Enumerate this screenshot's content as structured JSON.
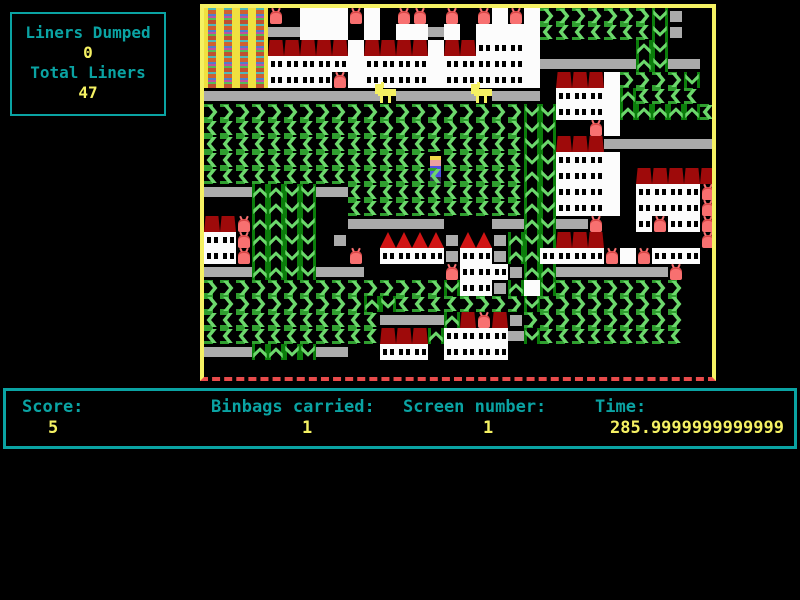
{
  "sidebar": {
    "liners_dumped_label": "Liners Dumped",
    "liners_dumped_value": "0",
    "total_liners_label": "Total Liners",
    "total_liners_value": "47"
  },
  "status_bar": {
    "score_label": "Score:",
    "score_value": "5",
    "binbags_label": "Binbags carried:",
    "binbags_value": "1",
    "screen_label": "Screen number:",
    "screen_value": "1",
    "time_label": "Time:",
    "time_value": "285.9999999999999"
  },
  "colors": {
    "text_teal": "#0aa3a3",
    "text_yellow": "#f5f163",
    "frame_yellow": "#f5f163",
    "frame_bottom_red": "#e84b4b",
    "chevron_light_green": "#6cd86c",
    "chevron_dark_green": "#0b7d0b",
    "conveyor_gray": "#ababab",
    "building_white": "#fcfcfc",
    "roof_dark_red": "#9e0a0a",
    "binbag_red": "#f87070",
    "background": "#000000"
  },
  "game_map": {
    "tile_size": 16,
    "cols": 32,
    "rows": 23,
    "legend": {
      ">": "chevron-right",
      "<": "chevron-left",
      "^": "ladder-up",
      "v": "ladder-down",
      "=": "conveyor",
      "g": "gray-block",
      "#": "building",
      "w": "building-window",
      "R": "roof-flat",
      "h": "roof-pitched",
      "b": "binbag",
      "Y": "rainbow-building",
      "D": "dog",
      "P": "player",
      ".": "empty"
    },
    "tiles": [
      "YYYYb.###b#.bb.b.b#b#>>>>>>>vg..",
      "YYYY==###.#.##=#.####<<<<<<<vg..",
      "YYYYRRRRR#RRRR#RRwww#......^v...",
      "YYYYwwwww#wwww#wwwww#======^v==.",
      "YYYYwwwwb#wwww#wwwww#.RRR#>>>>v.",
      "===========D=====D===.www#^<<<<.",
      ">>>>>>>>>>>>>>>>>>>>vvwww#^^^^^<",
      "<<<<<<<<<<<>>>>>>>>>vv..b#......",
      "<<<<<<<<<<<<<<<<<<<<v^RRR=======",
      "<<<<<<<<<<<<<<P<<<<<vvwww#......",
      "<<<<<<<<<<<<<<<<<<<<^vwww#.RRRRR",
      "===^^vv==<<<<<<<<<<<^vwww#.wwwwb",
      "...^^vv..<<<<<<<<<<<^vwww#.wwwwb",
      "RRb^^vv..======...==^v==b..wbwwb",
      "wwb^^vv.g..hhhhghhg^vvRRR......b",
      "wwb^^vv..b.wwwwgwwg^^wwwwb#bwww.",
      "===^^vv===.....bwwwg^^=======b..",
      ">>>>>>>>>>>>>>>vwwg^#v>>>>>>>>..",
      ">>>>>>>>>>^v<<<<>>>>v>>>>>>>>>..",
      "<<<<<<<<<<<====^RbRg>>>>>>>>>>..",
      "<<<<<<<<<<<RRR^wwww=v<<<<<<<<<..",
      "===^^vv==..www.wwww.............",
      "................................"
    ]
  }
}
